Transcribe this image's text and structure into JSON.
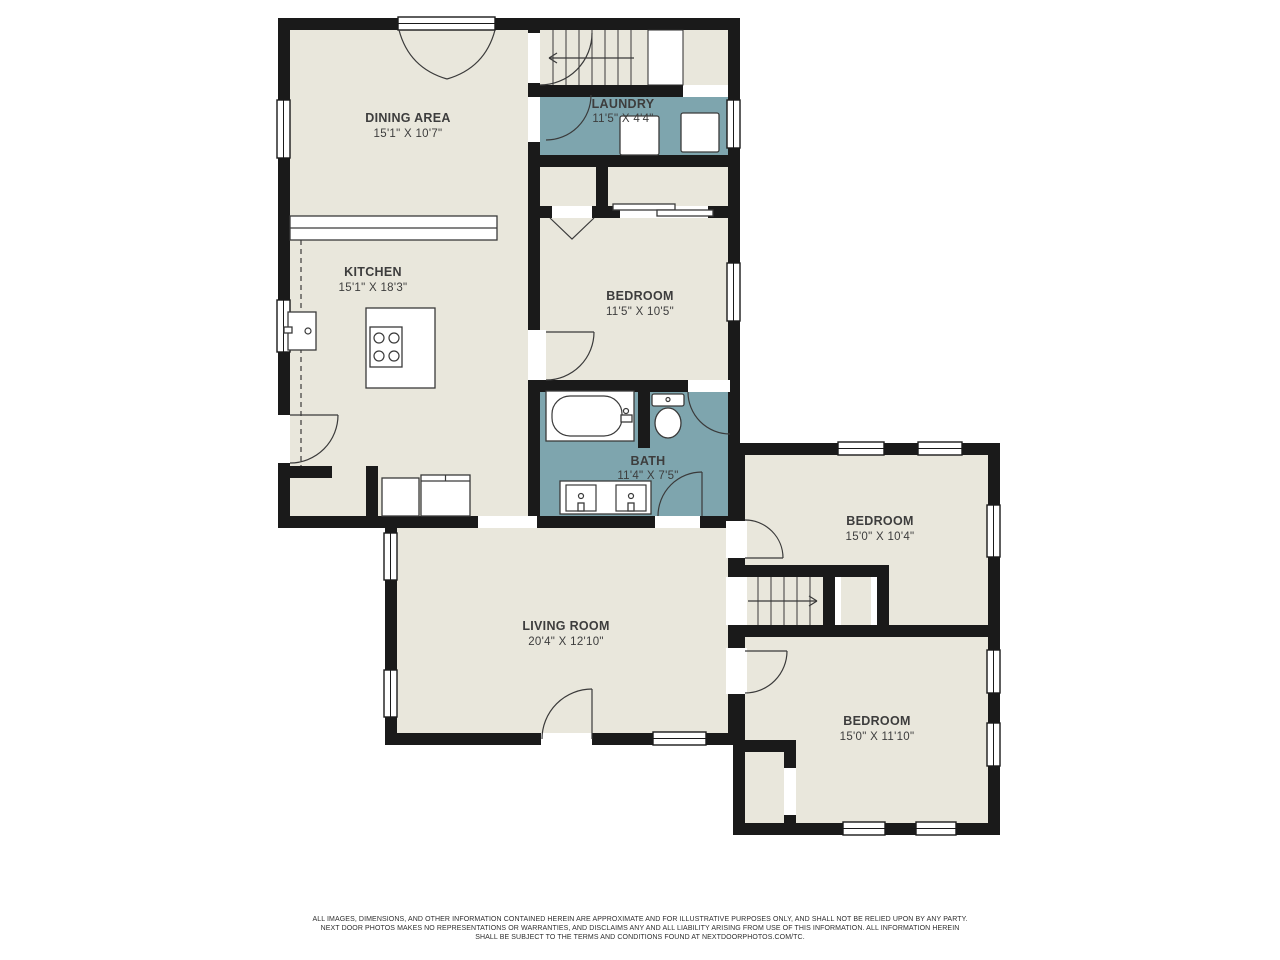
{
  "floorplan": {
    "rooms": {
      "dining": {
        "name": "DINING AREA",
        "dims": "15'1\" X 10'7\""
      },
      "kitchen": {
        "name": "KITCHEN",
        "dims": "15'1\" X 18'3\""
      },
      "laundry": {
        "name": "LAUNDRY",
        "dims": "11'5\" X 4'4\""
      },
      "bedroom1": {
        "name": "BEDROOM",
        "dims": "11'5\" X 10'5\""
      },
      "bath": {
        "name": "BATH",
        "dims": "11'4\" X 7'5\""
      },
      "living": {
        "name": "LIVING ROOM",
        "dims": "20'4\" X 12'10\""
      },
      "bedroom2": {
        "name": "BEDROOM",
        "dims": "15'0\" X 10'4\""
      },
      "bedroom3": {
        "name": "BEDROOM",
        "dims": "15'0\" X 11'10\""
      }
    },
    "colors": {
      "room_fill": "#E9E7DC",
      "wet_room_fill": "#7EA5AE",
      "wall": "#1A1A1A",
      "background": "#FFFFFF"
    }
  },
  "footer": {
    "lines": [
      "ALL IMAGES, DIMENSIONS, AND OTHER INFORMATION CONTAINED HEREIN ARE APPROXIMATE AND FOR ILLUSTRATIVE PURPOSES ONLY, AND SHALL NOT BE RELIED UPON BY ANY PARTY.",
      "NEXT DOOR PHOTOS MAKES NO REPRESENTATIONS OR WARRANTIES, AND DISCLAIMS ANY AND ALL LIABILITY ARISING FROM USE OF THIS INFORMATION. ALL INFORMATION HEREIN",
      "SHALL BE SUBJECT TO THE TERMS AND CONDITIONS FOUND AT NEXTDOORPHOTOS.COM/TC."
    ]
  }
}
